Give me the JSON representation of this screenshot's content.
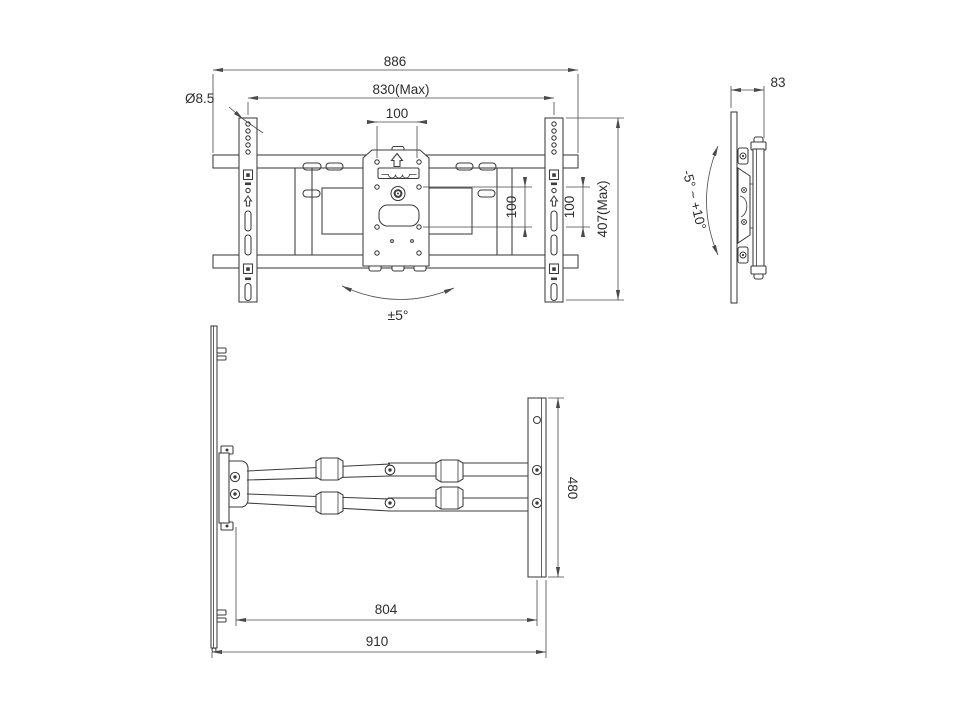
{
  "front_view": {
    "overall_width": "886",
    "rail_span": "830(Max)",
    "vesa_width": "100",
    "hole_diameter": "Ø8.5",
    "vesa_height_inner": "100",
    "vesa_height_outer": "100",
    "overall_height": "407(Max)",
    "swivel_angle": "±5°"
  },
  "side_view": {
    "depth": "83",
    "tilt_range": "-5° ~ +10°"
  },
  "top_view": {
    "arm_extension": "804",
    "max_extension": "910",
    "wall_plate_width": "480"
  }
}
